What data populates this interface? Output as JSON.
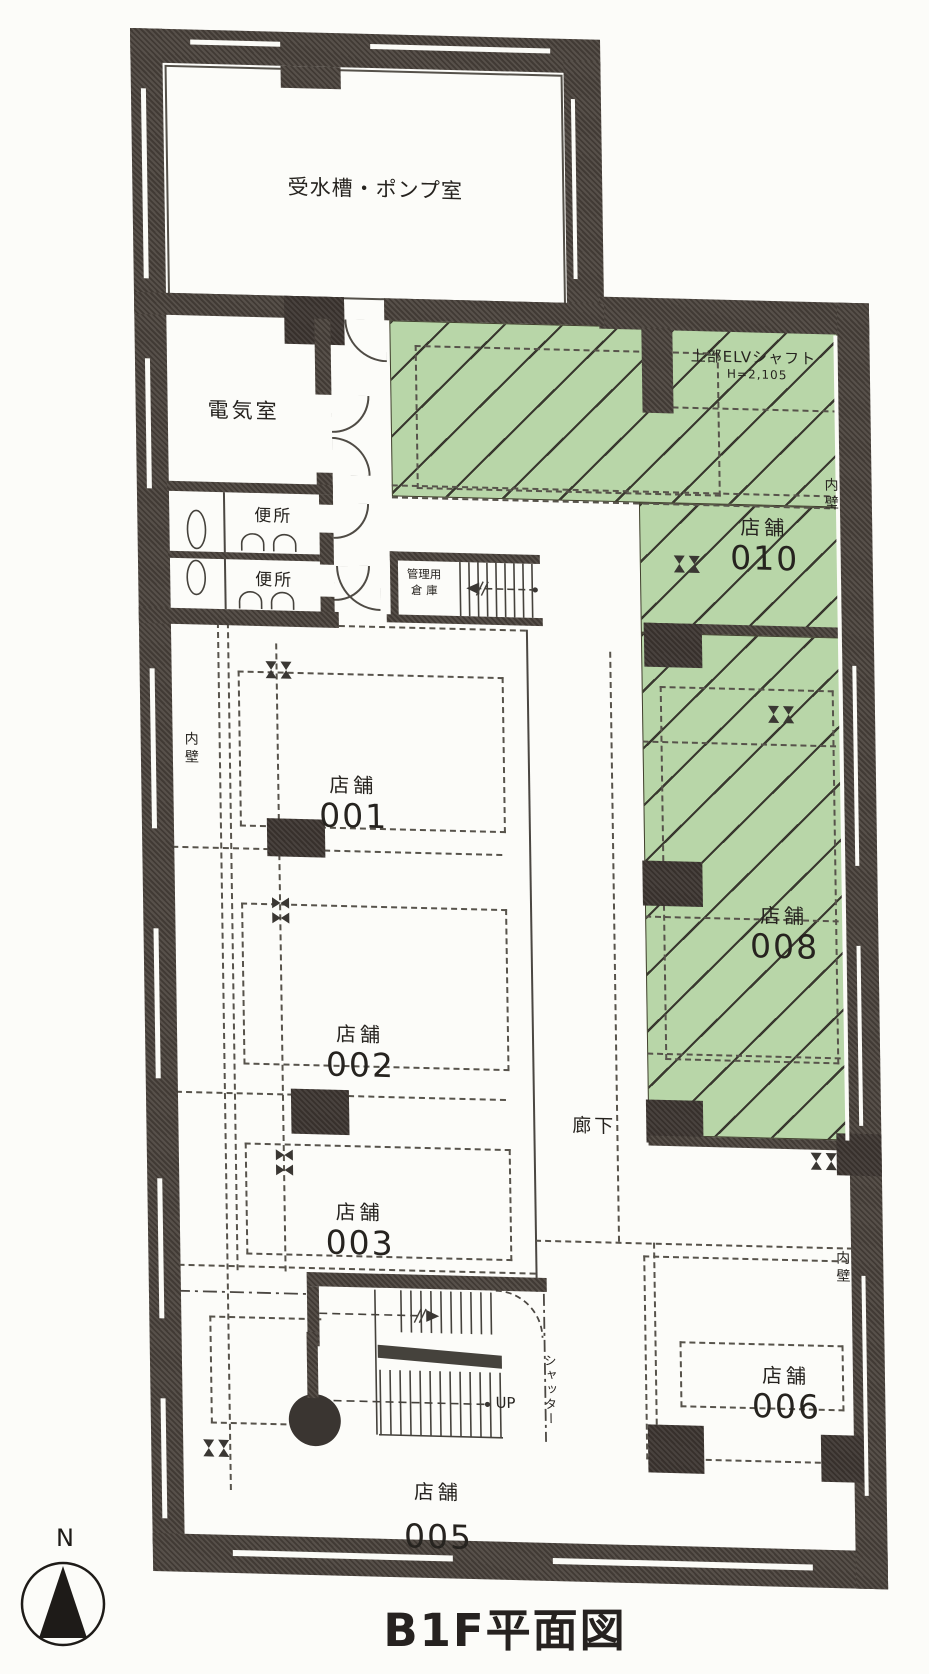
{
  "plan_title": "B1F平面図",
  "compass": {
    "north_label": "N"
  },
  "rooms": {
    "pump_room": "受水槽・ポンプ室",
    "electrical_room": "電気室",
    "toilet_upper": "便所",
    "toilet_lower": "便所",
    "storage_line1": "管理用",
    "storage_line2": "倉 庫",
    "corridor": "廊下"
  },
  "elevator_shaft": {
    "line1": "上部ELVシャフト",
    "line2": "H=2,105"
  },
  "shops": [
    {
      "label": "店舗",
      "number": "001",
      "highlighted": false
    },
    {
      "label": "店舗",
      "number": "002",
      "highlighted": false
    },
    {
      "label": "店舗",
      "number": "003",
      "highlighted": false
    },
    {
      "label": "店舗",
      "number": "005",
      "highlighted": false
    },
    {
      "label": "店舗",
      "number": "006",
      "highlighted": false
    },
    {
      "label": "店舗",
      "number": "008",
      "highlighted": true
    },
    {
      "label": "店舗",
      "number": "010",
      "highlighted": true
    }
  ],
  "wall_labels": {
    "inner_wall_left": "内壁",
    "inner_wall_right_upper": "内壁",
    "inner_wall_right_lower": "内壁"
  },
  "stair_labels": {
    "up": "UP",
    "shutter": "シャッター"
  },
  "colors": {
    "highlight_green": "#b8d6a8",
    "wall_dark": "#49423c"
  }
}
